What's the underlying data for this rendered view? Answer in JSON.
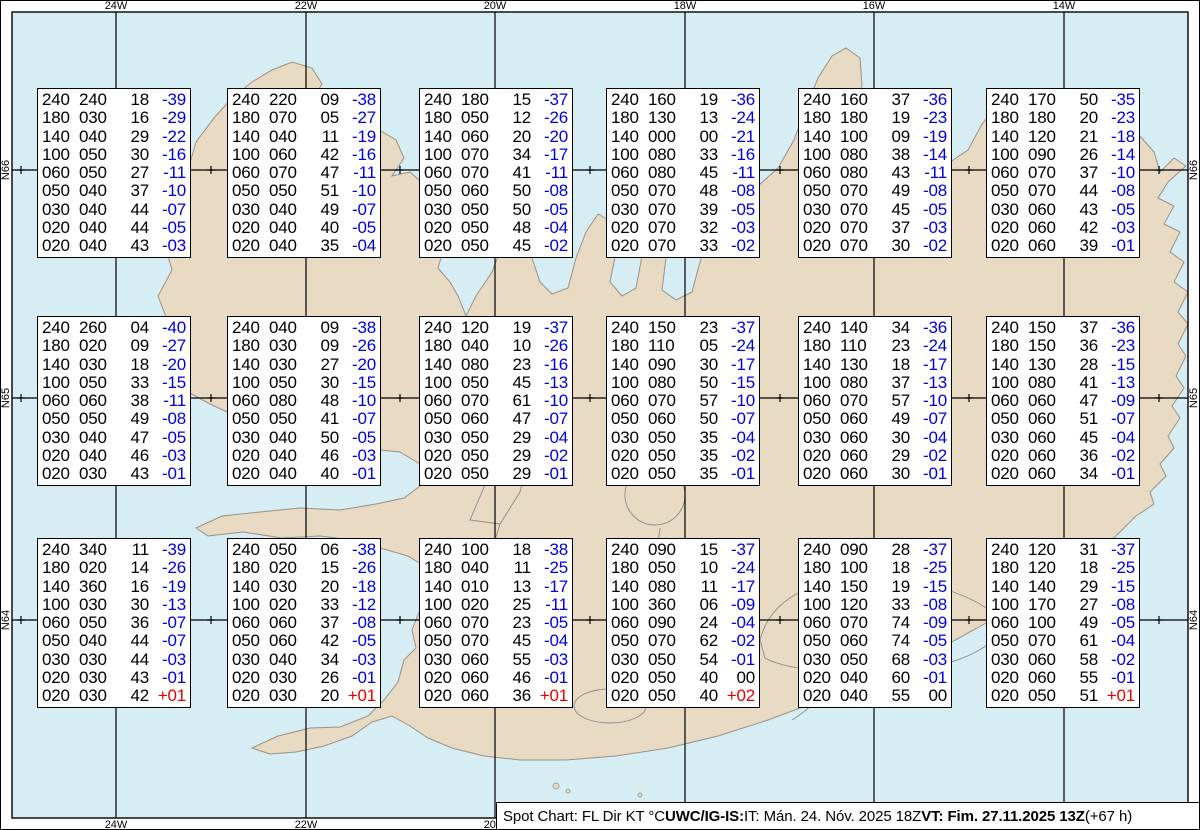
{
  "map": {
    "sea_color": "#d6edf4",
    "land_color": "#e9dac3",
    "coast_color": "#9a9186",
    "grid_color": "#000000",
    "meridians": [
      {
        "label": "24W",
        "x": 116
      },
      {
        "label": "22W",
        "x": 306
      },
      {
        "label": "20W",
        "x": 495
      },
      {
        "label": "18W",
        "x": 685
      },
      {
        "label": "16W",
        "x": 874
      },
      {
        "label": "14W",
        "x": 1064
      }
    ],
    "parallels": [
      {
        "label": "N66",
        "y": 170
      },
      {
        "label": "N65",
        "y": 398
      },
      {
        "label": "N64",
        "y": 620
      }
    ],
    "minor_tick_xs": [
      21,
      211,
      400,
      590,
      780,
      969,
      1159
    ]
  },
  "temp_colors": {
    "negative": "#0000dd",
    "positive": "#e60000",
    "zero": "#000000"
  },
  "status_bar": {
    "label_prefix": "Spot Chart: FL Dir KT °C ",
    "source": "UWC/IG-IS:",
    "issue_time": " IT: Mán. 24. Nóv. 2025 18Z ",
    "valid_time": "VT: Fim. 27.11.2025 13Z",
    "offset": " (+67 h)"
  },
  "boxes": [
    {
      "x": 37,
      "y": 88,
      "rows": [
        [
          "240",
          "240",
          "18",
          "-39"
        ],
        [
          "180",
          "030",
          "16",
          "-29"
        ],
        [
          "140",
          "040",
          "29",
          "-22"
        ],
        [
          "100",
          "050",
          "30",
          "-16"
        ],
        [
          "060",
          "050",
          "27",
          "-11"
        ],
        [
          "050",
          "040",
          "37",
          "-10"
        ],
        [
          "030",
          "040",
          "44",
          "-07"
        ],
        [
          "020",
          "040",
          "44",
          "-05"
        ],
        [
          "020",
          "040",
          "43",
          "-03"
        ]
      ]
    },
    {
      "x": 227,
      "y": 88,
      "rows": [
        [
          "240",
          "220",
          "09",
          "-38"
        ],
        [
          "180",
          "070",
          "05",
          "-27"
        ],
        [
          "140",
          "040",
          "11",
          "-19"
        ],
        [
          "100",
          "060",
          "42",
          "-16"
        ],
        [
          "060",
          "070",
          "47",
          "-11"
        ],
        [
          "050",
          "050",
          "51",
          "-10"
        ],
        [
          "030",
          "040",
          "49",
          "-07"
        ],
        [
          "020",
          "040",
          "40",
          "-05"
        ],
        [
          "020",
          "040",
          "35",
          "-04"
        ]
      ]
    },
    {
      "x": 419,
      "y": 88,
      "rows": [
        [
          "240",
          "180",
          "15",
          "-37"
        ],
        [
          "180",
          "050",
          "12",
          "-26"
        ],
        [
          "140",
          "060",
          "20",
          "-20"
        ],
        [
          "100",
          "070",
          "34",
          "-17"
        ],
        [
          "060",
          "070",
          "41",
          "-11"
        ],
        [
          "050",
          "060",
          "50",
          "-08"
        ],
        [
          "030",
          "050",
          "50",
          "-05"
        ],
        [
          "020",
          "050",
          "48",
          "-04"
        ],
        [
          "020",
          "050",
          "45",
          "-02"
        ]
      ]
    },
    {
      "x": 606,
      "y": 88,
      "rows": [
        [
          "240",
          "160",
          "19",
          "-36"
        ],
        [
          "180",
          "130",
          "13",
          "-24"
        ],
        [
          "140",
          "000",
          "00",
          "-21"
        ],
        [
          "100",
          "080",
          "33",
          "-16"
        ],
        [
          "060",
          "080",
          "45",
          "-11"
        ],
        [
          "050",
          "070",
          "48",
          "-08"
        ],
        [
          "030",
          "070",
          "39",
          "-05"
        ],
        [
          "020",
          "070",
          "32",
          "-03"
        ],
        [
          "020",
          "070",
          "33",
          "-02"
        ]
      ]
    },
    {
      "x": 798,
      "y": 88,
      "rows": [
        [
          "240",
          "160",
          "37",
          "-36"
        ],
        [
          "180",
          "180",
          "19",
          "-23"
        ],
        [
          "140",
          "100",
          "09",
          "-19"
        ],
        [
          "100",
          "080",
          "38",
          "-14"
        ],
        [
          "060",
          "080",
          "43",
          "-11"
        ],
        [
          "050",
          "070",
          "49",
          "-08"
        ],
        [
          "030",
          "070",
          "45",
          "-05"
        ],
        [
          "020",
          "070",
          "37",
          "-03"
        ],
        [
          "020",
          "070",
          "30",
          "-02"
        ]
      ]
    },
    {
      "x": 986,
      "y": 88,
      "rows": [
        [
          "240",
          "170",
          "50",
          "-35"
        ],
        [
          "180",
          "180",
          "20",
          "-23"
        ],
        [
          "140",
          "120",
          "21",
          "-18"
        ],
        [
          "100",
          "090",
          "26",
          "-14"
        ],
        [
          "060",
          "070",
          "37",
          "-10"
        ],
        [
          "050",
          "070",
          "44",
          "-08"
        ],
        [
          "030",
          "060",
          "43",
          "-05"
        ],
        [
          "020",
          "060",
          "42",
          "-03"
        ],
        [
          "020",
          "060",
          "39",
          "-01"
        ]
      ]
    },
    {
      "x": 37,
      "y": 316,
      "rows": [
        [
          "240",
          "260",
          "04",
          "-40"
        ],
        [
          "180",
          "020",
          "09",
          "-27"
        ],
        [
          "140",
          "030",
          "18",
          "-20"
        ],
        [
          "100",
          "050",
          "33",
          "-15"
        ],
        [
          "060",
          "060",
          "38",
          "-11"
        ],
        [
          "050",
          "050",
          "49",
          "-08"
        ],
        [
          "030",
          "040",
          "47",
          "-05"
        ],
        [
          "020",
          "040",
          "46",
          "-03"
        ],
        [
          "020",
          "030",
          "43",
          "-01"
        ]
      ]
    },
    {
      "x": 227,
      "y": 316,
      "rows": [
        [
          "240",
          "040",
          "09",
          "-38"
        ],
        [
          "180",
          "030",
          "09",
          "-26"
        ],
        [
          "140",
          "030",
          "27",
          "-20"
        ],
        [
          "100",
          "050",
          "30",
          "-15"
        ],
        [
          "060",
          "080",
          "48",
          "-10"
        ],
        [
          "050",
          "050",
          "41",
          "-07"
        ],
        [
          "030",
          "040",
          "50",
          "-05"
        ],
        [
          "020",
          "040",
          "46",
          "-03"
        ],
        [
          "020",
          "040",
          "40",
          "-01"
        ]
      ]
    },
    {
      "x": 419,
      "y": 316,
      "rows": [
        [
          "240",
          "120",
          "19",
          "-37"
        ],
        [
          "180",
          "040",
          "10",
          "-26"
        ],
        [
          "140",
          "080",
          "23",
          "-16"
        ],
        [
          "100",
          "050",
          "45",
          "-13"
        ],
        [
          "060",
          "070",
          "61",
          "-10"
        ],
        [
          "050",
          "060",
          "47",
          "-07"
        ],
        [
          "030",
          "050",
          "29",
          "-04"
        ],
        [
          "020",
          "050",
          "29",
          "-02"
        ],
        [
          "020",
          "050",
          "29",
          "-01"
        ]
      ]
    },
    {
      "x": 606,
      "y": 316,
      "rows": [
        [
          "240",
          "150",
          "23",
          "-37"
        ],
        [
          "180",
          "110",
          "05",
          "-24"
        ],
        [
          "140",
          "090",
          "30",
          "-17"
        ],
        [
          "100",
          "080",
          "50",
          "-15"
        ],
        [
          "060",
          "070",
          "57",
          "-10"
        ],
        [
          "050",
          "060",
          "50",
          "-07"
        ],
        [
          "030",
          "050",
          "35",
          "-04"
        ],
        [
          "020",
          "050",
          "35",
          "-02"
        ],
        [
          "020",
          "050",
          "35",
          "-01"
        ]
      ]
    },
    {
      "x": 798,
      "y": 316,
      "rows": [
        [
          "240",
          "140",
          "34",
          "-36"
        ],
        [
          "180",
          "110",
          "23",
          "-24"
        ],
        [
          "140",
          "130",
          "18",
          "-17"
        ],
        [
          "100",
          "080",
          "37",
          "-13"
        ],
        [
          "060",
          "070",
          "57",
          "-10"
        ],
        [
          "050",
          "060",
          "49",
          "-07"
        ],
        [
          "030",
          "060",
          "30",
          "-04"
        ],
        [
          "020",
          "060",
          "29",
          "-02"
        ],
        [
          "020",
          "060",
          "30",
          "-01"
        ]
      ]
    },
    {
      "x": 986,
      "y": 316,
      "rows": [
        [
          "240",
          "150",
          "37",
          "-36"
        ],
        [
          "180",
          "150",
          "36",
          "-23"
        ],
        [
          "140",
          "130",
          "28",
          "-15"
        ],
        [
          "100",
          "080",
          "41",
          "-13"
        ],
        [
          "060",
          "060",
          "47",
          "-09"
        ],
        [
          "050",
          "060",
          "51",
          "-07"
        ],
        [
          "030",
          "060",
          "45",
          "-04"
        ],
        [
          "020",
          "060",
          "36",
          "-02"
        ],
        [
          "020",
          "060",
          "34",
          "-01"
        ]
      ]
    },
    {
      "x": 37,
      "y": 538,
      "rows": [
        [
          "240",
          "340",
          "11",
          "-39"
        ],
        [
          "180",
          "020",
          "14",
          "-26"
        ],
        [
          "140",
          "360",
          "16",
          "-19"
        ],
        [
          "100",
          "030",
          "30",
          "-13"
        ],
        [
          "060",
          "050",
          "36",
          "-07"
        ],
        [
          "050",
          "040",
          "44",
          "-07"
        ],
        [
          "030",
          "030",
          "44",
          "-03"
        ],
        [
          "020",
          "030",
          "43",
          "-01"
        ],
        [
          "020",
          "030",
          "42",
          "+01"
        ]
      ]
    },
    {
      "x": 227,
      "y": 538,
      "rows": [
        [
          "240",
          "050",
          "06",
          "-38"
        ],
        [
          "180",
          "020",
          "15",
          "-26"
        ],
        [
          "140",
          "030",
          "20",
          "-18"
        ],
        [
          "100",
          "020",
          "33",
          "-12"
        ],
        [
          "060",
          "060",
          "37",
          "-08"
        ],
        [
          "050",
          "060",
          "42",
          "-05"
        ],
        [
          "030",
          "040",
          "34",
          "-03"
        ],
        [
          "020",
          "030",
          "26",
          "-01"
        ],
        [
          "020",
          "030",
          "20",
          "+01"
        ]
      ]
    },
    {
      "x": 419,
      "y": 538,
      "rows": [
        [
          "240",
          "100",
          "18",
          "-38"
        ],
        [
          "180",
          "040",
          "11",
          "-25"
        ],
        [
          "140",
          "010",
          "13",
          "-17"
        ],
        [
          "100",
          "020",
          "25",
          "-11"
        ],
        [
          "060",
          "070",
          "23",
          "-05"
        ],
        [
          "050",
          "070",
          "45",
          "-04"
        ],
        [
          "030",
          "060",
          "55",
          "-03"
        ],
        [
          "020",
          "060",
          "46",
          "-01"
        ],
        [
          "020",
          "060",
          "36",
          "+01"
        ]
      ]
    },
    {
      "x": 606,
      "y": 538,
      "rows": [
        [
          "240",
          "090",
          "15",
          "-37"
        ],
        [
          "180",
          "050",
          "10",
          "-24"
        ],
        [
          "140",
          "080",
          "11",
          "-17"
        ],
        [
          "100",
          "360",
          "06",
          "-09"
        ],
        [
          "060",
          "090",
          "24",
          "-04"
        ],
        [
          "050",
          "070",
          "62",
          "-02"
        ],
        [
          "030",
          "050",
          "54",
          "-01"
        ],
        [
          "020",
          "050",
          "40",
          "00"
        ],
        [
          "020",
          "050",
          "40",
          "+02"
        ]
      ]
    },
    {
      "x": 798,
      "y": 538,
      "rows": [
        [
          "240",
          "090",
          "28",
          "-37"
        ],
        [
          "180",
          "100",
          "18",
          "-25"
        ],
        [
          "140",
          "150",
          "19",
          "-15"
        ],
        [
          "100",
          "120",
          "33",
          "-08"
        ],
        [
          "060",
          "070",
          "74",
          "-09"
        ],
        [
          "050",
          "060",
          "74",
          "-05"
        ],
        [
          "030",
          "050",
          "68",
          "-03"
        ],
        [
          "020",
          "040",
          "60",
          "-01"
        ],
        [
          "020",
          "040",
          "55",
          "00"
        ]
      ]
    },
    {
      "x": 986,
      "y": 538,
      "rows": [
        [
          "240",
          "120",
          "31",
          "-37"
        ],
        [
          "180",
          "120",
          "18",
          "-25"
        ],
        [
          "140",
          "140",
          "29",
          "-15"
        ],
        [
          "100",
          "170",
          "27",
          "-08"
        ],
        [
          "060",
          "100",
          "49",
          "-05"
        ],
        [
          "050",
          "070",
          "61",
          "-04"
        ],
        [
          "030",
          "060",
          "58",
          "-02"
        ],
        [
          "020",
          "060",
          "55",
          "-01"
        ],
        [
          "020",
          "050",
          "51",
          "+01"
        ]
      ]
    }
  ]
}
